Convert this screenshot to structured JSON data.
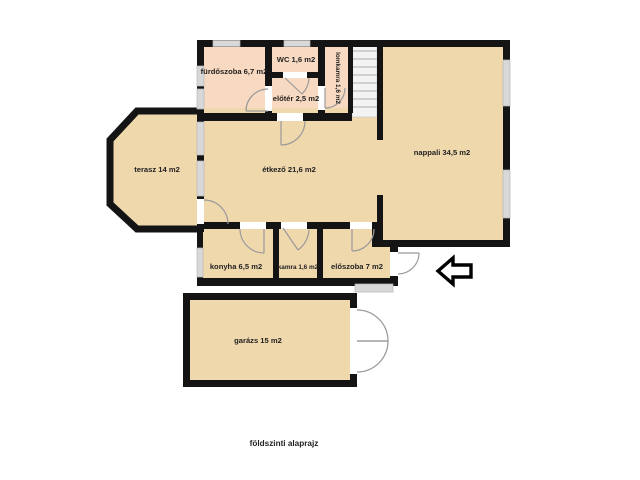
{
  "caption": "földszinti alaprajz",
  "rooms": [
    {
      "id": "furdoszoba",
      "label": "fürdőszoba 6,7 m2"
    },
    {
      "id": "wc",
      "label": "WC 1,6 m2"
    },
    {
      "id": "eloter",
      "label": "előtér 2,5 m2"
    },
    {
      "id": "lomkamra",
      "label": "lomkamra 1,6 m2"
    },
    {
      "id": "terasz",
      "label": "terasz 14 m2"
    },
    {
      "id": "etkezo",
      "label": "étkező 21,6 m2"
    },
    {
      "id": "nappali",
      "label": "nappali 34,5 m2"
    },
    {
      "id": "konyha",
      "label": "konyha 6,5 m2"
    },
    {
      "id": "kamra",
      "label": "kamra 1,6 m2"
    },
    {
      "id": "eloszoba",
      "label": "előszoba 7 m2"
    },
    {
      "id": "garazs",
      "label": "garázs 15 m2"
    }
  ],
  "icons": {
    "direction_arrow": "left-arrow",
    "stairs": "staircase"
  },
  "colors": {
    "background": "#ffffff",
    "wall": "#141414",
    "floor": "#f0d8ad",
    "wet_room_floor": "#f8d9c1",
    "window": "#d8d8d8",
    "stairs": "#f3f3f3",
    "door_swing": "#9a9a9a",
    "arrow_outline": "#000000",
    "arrow_fill": "#ffffff"
  }
}
